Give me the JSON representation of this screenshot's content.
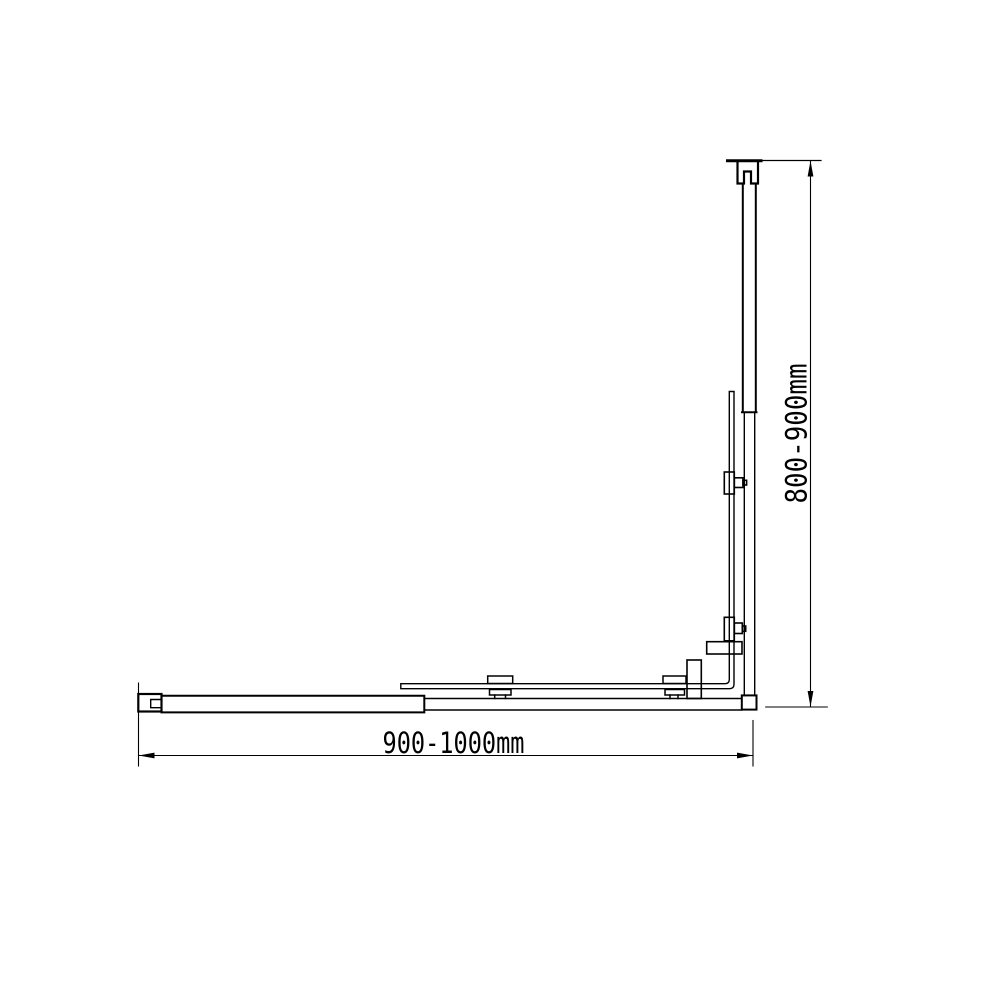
{
  "diagram": {
    "dimensions": {
      "width": {
        "label": "900-1000mm",
        "range_mm": [
          900,
          1000
        ]
      },
      "height": {
        "label": "800-900mm",
        "range_mm": [
          800,
          900
        ]
      }
    },
    "colors": {
      "line": "#000000",
      "background": "#ffffff"
    }
  }
}
